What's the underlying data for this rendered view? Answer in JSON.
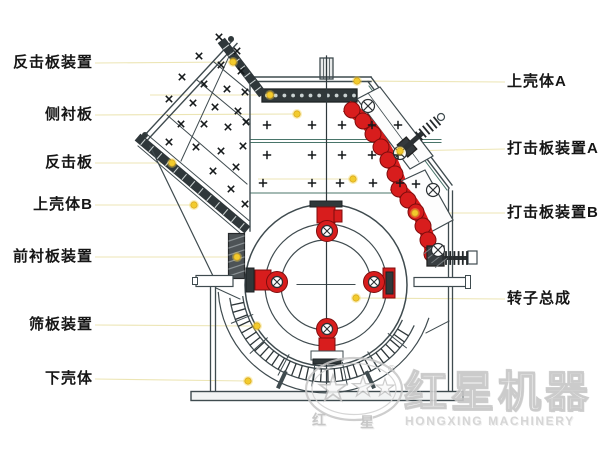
{
  "title": "impact-crusher-structure-diagram",
  "labels": {
    "left": [
      {
        "text": "反击板装置",
        "y": 63,
        "dot": [
          233,
          62
        ]
      },
      {
        "text": "侧衬板",
        "y": 115,
        "dot": [
          297,
          114
        ]
      },
      {
        "text": "反击板",
        "y": 163,
        "dot": [
          172,
          163
        ]
      },
      {
        "text": "上壳体B",
        "y": 205,
        "dot": [
          194,
          205
        ]
      },
      {
        "text": "前衬板装置",
        "y": 257,
        "dot": [
          237,
          257
        ]
      },
      {
        "text": "筛板装置",
        "y": 325,
        "dot": [
          257,
          326
        ]
      },
      {
        "text": "下壳体",
        "y": 379,
        "dot": [
          248,
          381
        ]
      }
    ],
    "right": [
      {
        "text": "上壳体A",
        "y": 82,
        "dot": [
          357,
          81
        ]
      },
      {
        "text": "打击板装置A",
        "y": 149,
        "dot": [
          400,
          151
        ]
      },
      {
        "text": "打击板装置B",
        "y": 213,
        "dot": [
          415,
          213
        ]
      },
      {
        "text": "转子总成",
        "y": 299,
        "dot": [
          356,
          298
        ]
      }
    ]
  },
  "extra_dots": [
    {
      "x": 270,
      "y": 95,
      "line_from": 150
    },
    {
      "x": 353,
      "y": 179,
      "line_from": 258
    }
  ],
  "diagram": {
    "colors": {
      "line": "#3f4b4f",
      "inner_line": "#49756a",
      "dark_fill": "#30383a",
      "red": "#d81d1d",
      "red_dark": "#7d0d0d",
      "dot_fill": "#f2cb2d",
      "dot_edge": "#d9a81c",
      "leader": "#ece5b4",
      "mark": "#15191b"
    },
    "x_marks": [
      [
        219,
        37
      ],
      [
        237,
        51
      ],
      [
        199,
        56
      ],
      [
        221,
        65
      ],
      [
        241,
        71
      ],
      [
        182,
        77
      ],
      [
        204,
        84
      ],
      [
        227,
        89
      ],
      [
        245,
        92
      ],
      [
        169,
        99
      ],
      [
        193,
        103
      ],
      [
        215,
        107
      ],
      [
        238,
        111
      ],
      [
        181,
        124
      ],
      [
        204,
        124
      ],
      [
        228,
        127
      ],
      [
        246,
        122
      ],
      [
        169,
        142
      ],
      [
        196,
        147
      ],
      [
        221,
        151
      ],
      [
        243,
        146
      ],
      [
        213,
        171
      ],
      [
        236,
        167
      ],
      [
        231,
        189
      ],
      [
        245,
        204
      ]
    ],
    "plus_marks": [
      [
        267,
        125
      ],
      [
        312,
        125
      ],
      [
        342,
        125
      ],
      [
        372,
        125
      ],
      [
        398,
        125
      ],
      [
        267,
        155
      ],
      [
        312,
        155
      ],
      [
        342,
        155
      ],
      [
        372,
        155
      ],
      [
        398,
        155
      ],
      [
        263,
        183
      ],
      [
        312,
        183
      ],
      [
        340,
        183
      ],
      [
        373,
        183
      ],
      [
        400,
        183
      ],
      [
        416,
        184
      ]
    ],
    "bolts_large": [
      [
        368,
        106
      ],
      [
        400,
        153
      ],
      [
        433,
        190
      ],
      [
        438,
        250
      ]
    ],
    "bolts_hammer": [
      [
        327,
        231
      ],
      [
        277,
        282
      ],
      [
        374,
        282
      ],
      [
        327,
        329
      ]
    ]
  },
  "logo": {
    "zh_small_1": "红",
    "zh_small_2": "星",
    "zh_big": "红星机器",
    "en": "HONGXING MACHINERY",
    "reg": "®"
  }
}
